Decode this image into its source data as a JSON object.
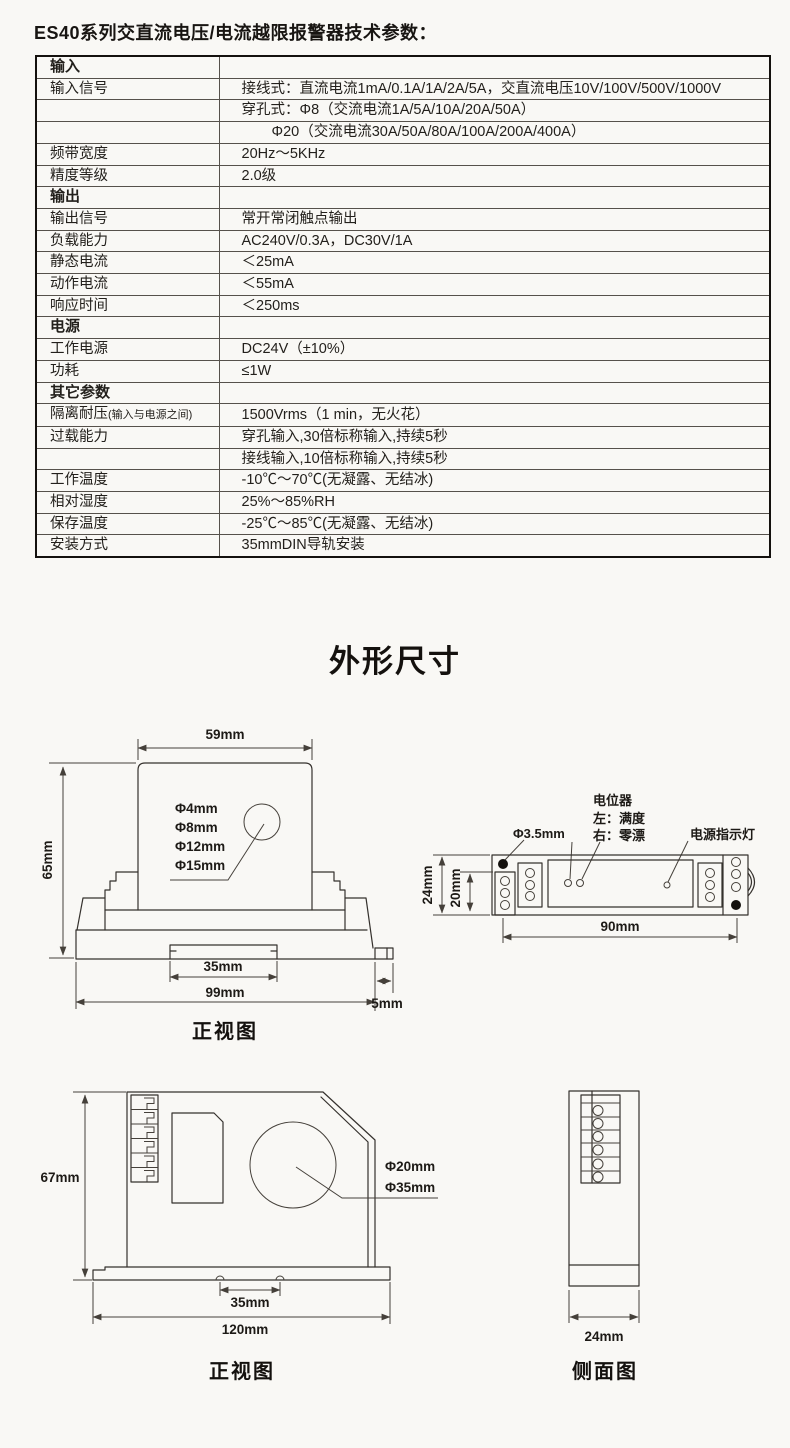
{
  "page": {
    "title": "ES40系列交直流电压/电流越限报警器技术参数："
  },
  "spec_table": {
    "rows": [
      {
        "label": "输入",
        "value": "",
        "type": "section"
      },
      {
        "label": "输入信号",
        "value": "接线式：直流电流1mA/0.1A/1A/2A/5A，交直流电压10V/100V/500V/1000V",
        "type": "item"
      },
      {
        "label": "",
        "value": "穿孔式：Φ8（交流电流1A/5A/10A/20A/50A）",
        "type": "item"
      },
      {
        "label": "",
        "value": "Φ20（交流电流30A/50A/80A/100A/200A/400A）",
        "type": "item-indent"
      },
      {
        "label": "频带宽度",
        "value": "20Hz～5KHz",
        "type": "item"
      },
      {
        "label": "精度等级",
        "value": "2.0级",
        "type": "item"
      },
      {
        "label": "输出",
        "value": "",
        "type": "section"
      },
      {
        "label": "输出信号",
        "value": "常开常闭触点输出",
        "type": "item"
      },
      {
        "label": "负载能力",
        "value": "AC240V/0.3A，DC30V/1A",
        "type": "item"
      },
      {
        "label": "静态电流",
        "value": "＜25mA",
        "type": "item"
      },
      {
        "label": "动作电流",
        "value": "＜55mA",
        "type": "item"
      },
      {
        "label": "响应时间",
        "value": "＜250ms",
        "type": "item"
      },
      {
        "label": "电源",
        "value": "",
        "type": "section"
      },
      {
        "label": "工作电源",
        "value": "DC24V（±10%）",
        "type": "item"
      },
      {
        "label": "功耗",
        "value": "≤1W",
        "type": "item"
      },
      {
        "label": "其它参数",
        "value": "",
        "type": "section"
      },
      {
        "label": "隔离耐压",
        "label_note": "(输入与电源之间)",
        "value": "1500Vrms（1 min，无火花）",
        "type": "item"
      },
      {
        "label": "过载能力",
        "value": "穿孔输入,30倍标称输入,持续5秒",
        "type": "item"
      },
      {
        "label": "",
        "value": "接线输入,10倍标称输入,持续5秒",
        "type": "item"
      },
      {
        "label": "工作温度",
        "value": "-10℃～70℃(无凝露、无结冰)",
        "type": "item"
      },
      {
        "label": "相对湿度",
        "value": "25%～85%RH",
        "type": "item"
      },
      {
        "label": "保存温度",
        "value": "-25℃～85℃(无凝露、无结冰)",
        "type": "item"
      },
      {
        "label": "安装方式",
        "value": "35mmDIN导轨安装",
        "type": "item"
      }
    ]
  },
  "outline_section": {
    "title": "外形尺寸"
  },
  "front_view_1": {
    "caption": "正视图",
    "dim_top_width": "59mm",
    "dim_height": "65mm",
    "dim_notch": "35mm",
    "dim_base_width": "99mm",
    "dim_tab": "5mm",
    "hole_labels": [
      "Φ4mm",
      "Φ8mm",
      "Φ12mm",
      "Φ15mm"
    ]
  },
  "top_view": {
    "label_potentiometer": "电位器",
    "label_pot_left": "左：满度",
    "label_pot_right": "右：零漂",
    "label_hole": "Φ3.5mm",
    "label_power_led": "电源指示灯",
    "dim_height": "24mm",
    "dim_inner_height": "20mm",
    "dim_hole_span": "90mm"
  },
  "front_view_2": {
    "caption": "正视图",
    "dim_height": "67mm",
    "dim_notch": "35mm",
    "dim_width": "120mm",
    "hole_labels": [
      "Φ20mm",
      "Φ35mm"
    ]
  },
  "side_view": {
    "caption": "侧面图",
    "dim_width": "24mm"
  }
}
